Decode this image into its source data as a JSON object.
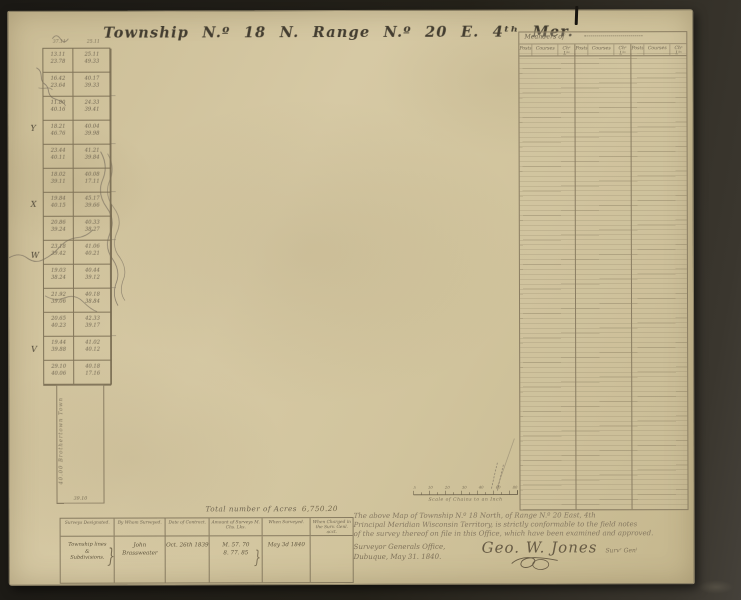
{
  "title": "Township N.º 18 N.  Range N.º 20 E.  4ᵗʰ    Mer.",
  "plat": {
    "top_distances": [
      "37.11",
      "25.11"
    ],
    "margin_letters": [
      "Y",
      "X",
      "W",
      "V"
    ],
    "rows": [
      [
        "13.11\n23.78",
        "25.11\n49.33"
      ],
      [
        "16.42\n23.64",
        "40.17\n39.33"
      ],
      [
        "11.80\n40.16",
        "24.33\n39.41"
      ],
      [
        "18.21\n46.76",
        "40.04\n39.98"
      ],
      [
        "23.44\n40.11",
        "41.21\n39.84"
      ],
      [
        "18.02\n39.11",
        "40.08\n17.11"
      ],
      [
        "19.84\n40.15",
        "45.17\n39.66"
      ],
      [
        "20.86\n39.24",
        "40.33\n38.27"
      ],
      [
        "23.18\n39.42",
        "41.06\n40.21"
      ],
      [
        "19.03\n38.24",
        "40.44\n39.12"
      ],
      [
        "21.92\n39.06",
        "40.18\n38.84"
      ],
      [
        "20.65\n40.23",
        "42.33\n39.17"
      ],
      [
        "19.44\n39.88",
        "41.02\n40.12"
      ],
      [
        "29.10\n40.06",
        "40.18\n17.16"
      ]
    ],
    "lower_tract": {
      "side_label": "40.00   Brothertown  Town",
      "bottom_label": "39.10"
    }
  },
  "meanders": {
    "title": "Meanders of",
    "col_labels": [
      "Posts",
      "Courses",
      "Chˢ Lᵏˢ"
    ]
  },
  "scale": {
    "tick_labels": [
      "5",
      "10",
      "20",
      "30",
      "40",
      "60",
      "80"
    ],
    "label": "Scale of Chains to an Inch"
  },
  "summary_table": {
    "total_label": "Total number of Acres",
    "total_value": "6,750.20",
    "headers": [
      "Surveys Designated.",
      "By Whom Surveyed.",
      "Date of Contract.",
      "Amount of Surveys M. Chs. Lks.",
      "When Surveyed.",
      "When Charged in the Surv. Genl. acct."
    ],
    "row": {
      "designated": "Township lines\n&\nSubdivisions.",
      "brace": "}",
      "surveyor": "John Brassweater",
      "contract_date": "Oct. 26th 1839",
      "amount": "M. 57. 70\n8. 77. 85",
      "when_surveyed": "May 3d 1840",
      "charged": ""
    }
  },
  "certification": {
    "lines": [
      "The above Map of Township N.º 18 North, of Range N.º 20 East, 4th",
      "Principal Meridian Wisconsin Territory, is strictly conformable to the field notes",
      "of the survey thereof on file in this Office, which have been examined and approved."
    ],
    "office_line1": "Surveyor Generals Office,",
    "office_line2": "Dubuque, May 31. 1840.",
    "signature": "Geo. W. Jones",
    "signature_title": "Survʳ Genˡ"
  },
  "colors": {
    "paper": "#d1c49d",
    "ink": "#4a4335",
    "faded_ink": "#7b7059",
    "surround": "#242119"
  }
}
